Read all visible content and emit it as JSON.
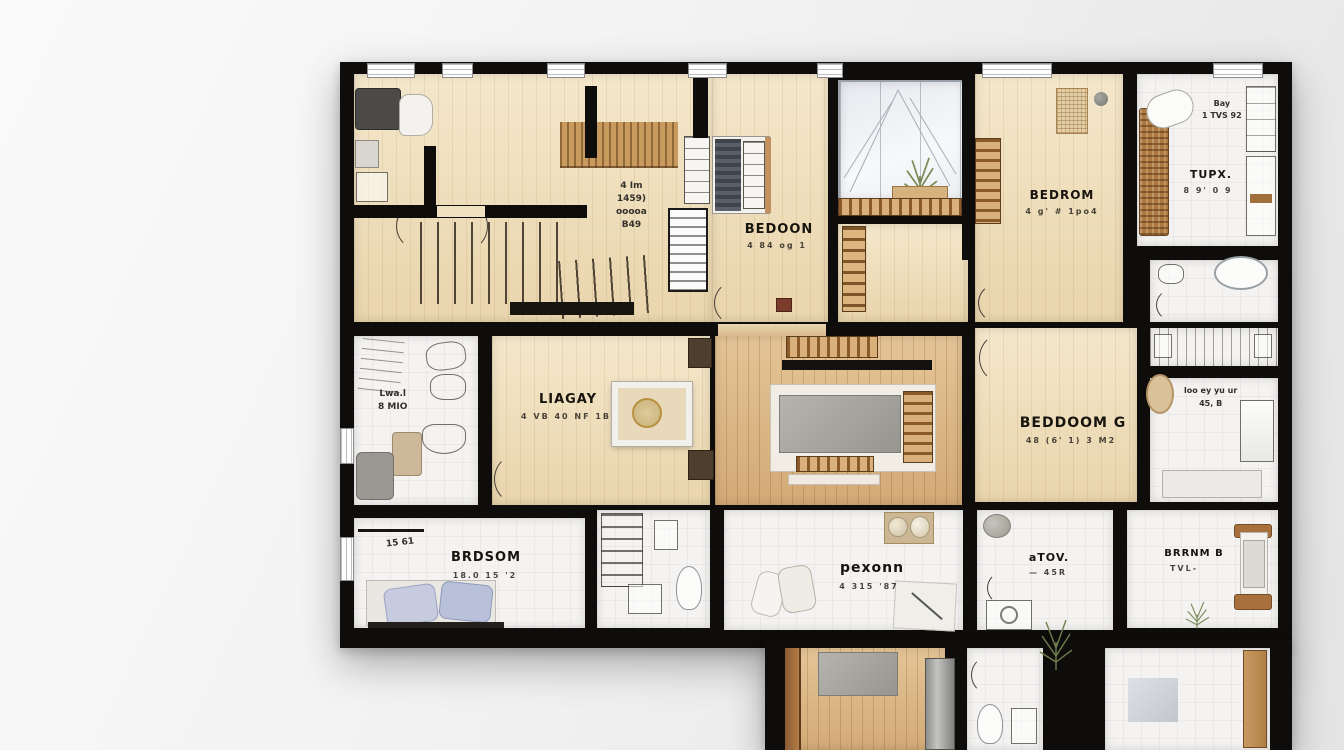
{
  "image": {
    "type": "architectural-floor-plan",
    "style": "AI-generated top-view apartment plan"
  },
  "palette": {
    "wall": "#0e0d0b",
    "beige_floor": "#eedcba",
    "wood_floor": "#d9b88c",
    "tile_floor": "#f4f3f1",
    "accent_wood": "#a9743f",
    "pillow": "#c3c8de",
    "background": "#efefef"
  },
  "labels": {
    "hall_note": {
      "l1": "4 Im",
      "l2": "1459)",
      "l3": "ooooa",
      "l4": "B49"
    },
    "bedroom_top": {
      "title": "BEDOON",
      "sub": "4 84 og 1"
    },
    "bedroom_right": {
      "title": "BEDROM",
      "sub": "4 g' # 1po4"
    },
    "tupx": {
      "title": "TUPX.",
      "sub": "8 9' 0 9",
      "note1": "Bay",
      "note2": "1 TVS 92"
    },
    "liagay": {
      "title": "LIAGAY",
      "sub": "4 VB 40 NF 1B"
    },
    "beddoom_g": {
      "title": "BEDDOOM G",
      "sub": "48 (6' 1) 3 M2"
    },
    "bath_right_note": {
      "l1": "loo ey yu ur",
      "l2": "45, B"
    },
    "bath_left_note": {
      "l1": "Lwa.l",
      "l2": "8 MIO"
    },
    "brdsom": {
      "title": "BRDSOM",
      "sub": "18.0 15 '2",
      "note": "15 61"
    },
    "pexonn": {
      "title": "pexonn",
      "sub": "4 315 '87"
    },
    "atov": {
      "title": "aTOV.",
      "sub": "— 45R"
    },
    "bedroom_b": {
      "title": "BRRNM B",
      "sub": "TVL-"
    }
  }
}
